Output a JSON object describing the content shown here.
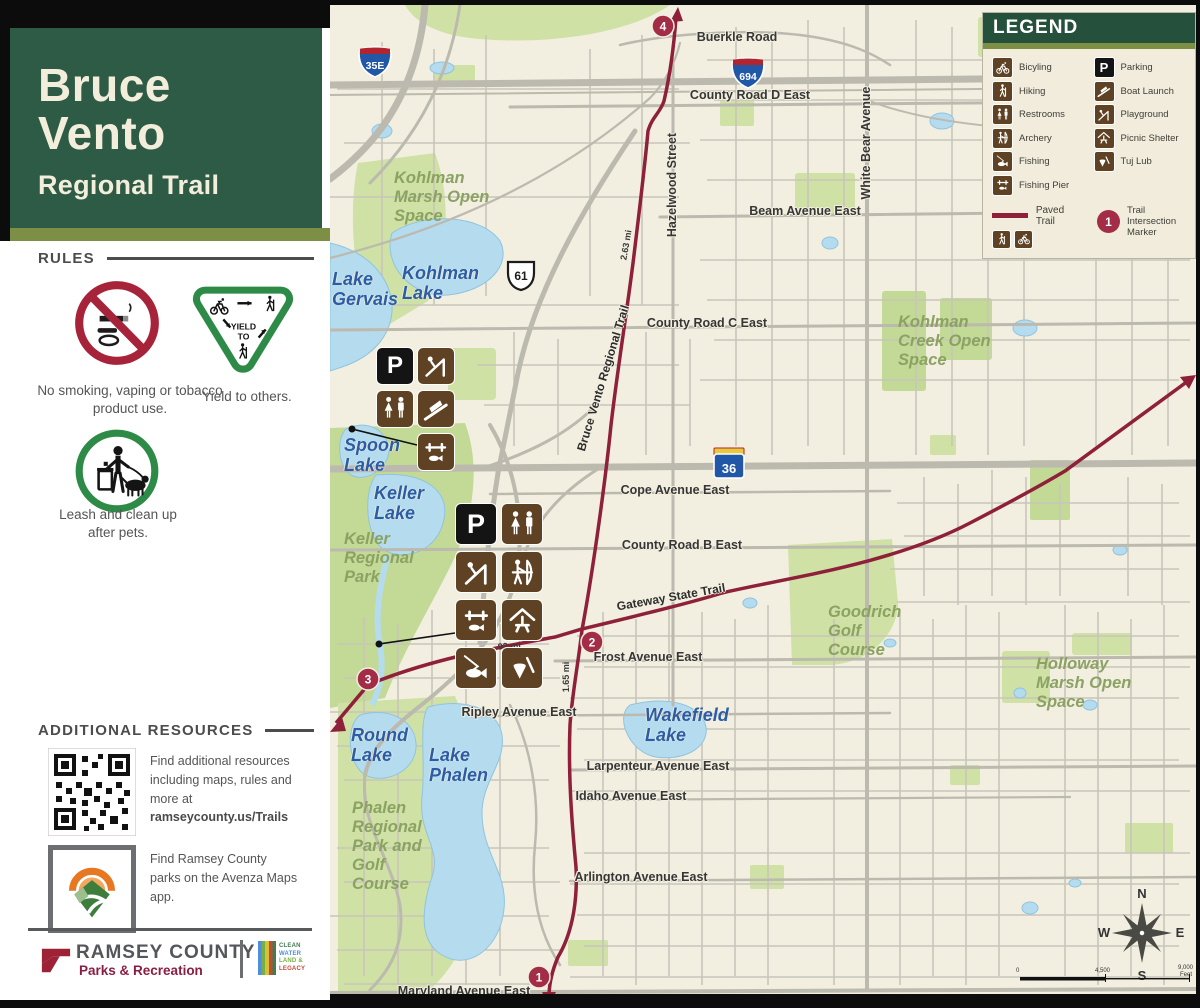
{
  "colors": {
    "header_green": "#2e5b46",
    "olive": "#7d8f44",
    "legend_header_green": "#24503c",
    "trail_red": "#8e2039",
    "marker_red": "#a32c46",
    "icon_brown": "#5e4223",
    "map_cream": "#f2efe0",
    "water_blue": "#b5dcee",
    "water_label_blue": "#2a5ca8",
    "green_space": "#cfe1a4",
    "green_label": "#8ba263",
    "road_gray": "#bcb9ae",
    "dept_red": "#8a1e41",
    "rule_red": "#a62339",
    "rule_green": "#2e8b47"
  },
  "icons": {
    "parking_glyph": "P"
  },
  "sidebar": {
    "title_line1": "Bruce",
    "title_line2": "Vento",
    "subtitle": "Regional Trail",
    "rules": {
      "heading": "RULES",
      "no_smoking_text": "No smoking, vaping or tobacco product use.",
      "yield_text": "Yield to others.",
      "yield_sign_word1": "YIELD",
      "yield_sign_word2": "TO",
      "leash_text": "Leash and clean up after pets."
    },
    "resources": {
      "heading": "ADDITIONAL RESOURCES",
      "qr_text": "Find additional resources including maps, rules and more at",
      "qr_link": "ramseycounty.us/Trails",
      "avenza_text": "Find Ramsey County parks on the Avenza Maps app."
    },
    "footer": {
      "org": "RAMSEY COUNTY",
      "dept": "Parks & Recreation",
      "legacy_lines": [
        "CLEAN",
        "WATER",
        "LAND &",
        "LEGACY"
      ]
    }
  },
  "legend": {
    "title": "LEGEND",
    "items_left": [
      {
        "label": "Bicyling"
      },
      {
        "label": "Hiking"
      },
      {
        "label": "Restrooms"
      },
      {
        "label": "Archery"
      },
      {
        "label": "Fishing"
      },
      {
        "label": "Fishing Pier"
      }
    ],
    "items_right": [
      {
        "label": "Parking"
      },
      {
        "label": "Boat Launch"
      },
      {
        "label": "Playground"
      },
      {
        "label": "Picnic Shelter"
      },
      {
        "label": "Tuj Lub"
      }
    ],
    "paved_trail_label": "Paved Trail",
    "intersection_label": "Trail Intersection Marker",
    "intersection_number": "1"
  },
  "map": {
    "highway_shields": {
      "i35e": "35E",
      "i694": "694",
      "us61": "61",
      "mn36": "36"
    },
    "street_labels": {
      "buerkle": "Buerkle Road",
      "county_d": "County Road D East",
      "beam": "Beam Avenue East",
      "county_c": "County Road C East",
      "cope": "Cope Avenue East",
      "county_b": "County Road B East",
      "frost": "Frost Avenue East",
      "ripley": "Ripley Avenue East",
      "larpenteur": "Larpenteur Avenue East",
      "idaho": "Idaho Avenue East",
      "arlington": "Arlington Avenue East",
      "maryland": "Maryland Avenue East",
      "hazelwood": "Hazelwood Street",
      "white_bear": "White Bear Avenue"
    },
    "water_labels": {
      "gervais": "Lake Gervais",
      "kohlman": "Kohlman Lake",
      "spoon": "Spoon Lake",
      "keller": "Keller Lake",
      "round": "Round Lake",
      "phalen": "Lake Phalen",
      "wakefield": "Wakefield Lake"
    },
    "area_labels": {
      "kohlman_marsh": "Kohlman Marsh Open Space",
      "kohlman_creek": "Kohlman Creek Open Space",
      "keller_park": "Keller Regional Park",
      "goodrich": "Goodrich Golf Course",
      "holloway": "Holloway Marsh Open Space",
      "phalen_park": "Phalen Regional Park and Golf Course"
    },
    "trail_labels": {
      "bruce_vento": "Bruce Vento Regional Trail",
      "gateway": "Gateway State Trail"
    },
    "mile_labels": {
      "north_segment": "2.63 mi",
      "south_segment": "1.65 mi",
      "gateway_segment": ".92 mi"
    },
    "intersection_markers": [
      "1",
      "2",
      "3",
      "4"
    ],
    "compass": {
      "n": "N",
      "e": "E",
      "s": "S",
      "w": "W"
    },
    "scale_bar": {
      "start": "0",
      "mid": "4,500",
      "end": "9,000",
      "unit": "Feet"
    }
  }
}
